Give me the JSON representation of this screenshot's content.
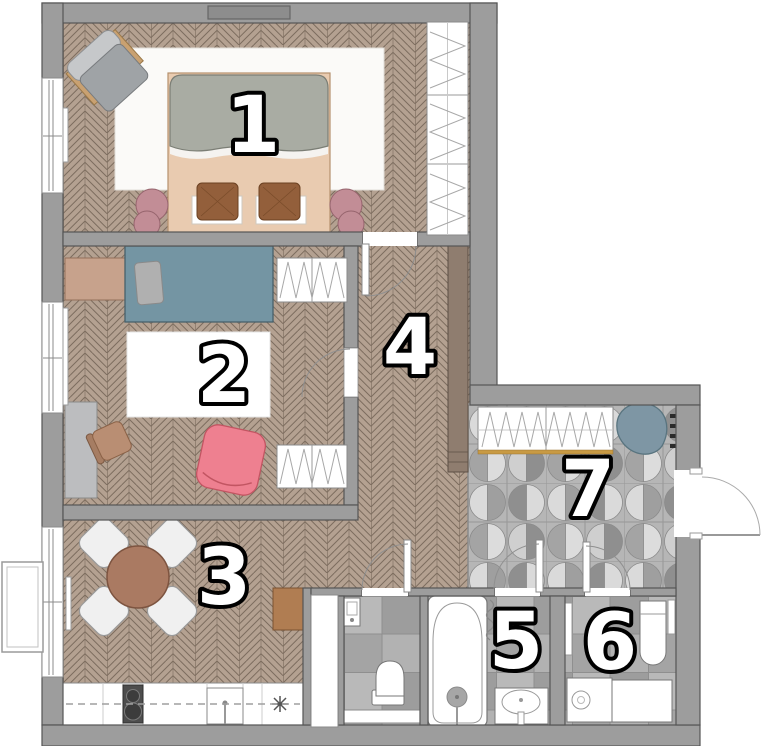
{
  "title": "Apartment floor plan",
  "rooms": [
    "1",
    "2",
    "3",
    "4",
    "5",
    "6",
    "7"
  ],
  "palette": {
    "wall": "#9d9d9d",
    "wall_outline": "#555555",
    "wood_floor": "#b4a191",
    "wood_floor_line": "#7c6c5e",
    "rug": "#fafafa",
    "tile_bg": "#b6b6b6",
    "tile_light": "#dadada",
    "tile_mid": "#a4a4a4",
    "tile_dark": "#8f8f8f",
    "bed_gray": "#a9aca3",
    "bed_peach": "#e9cbb0",
    "cushion_brown": "#935f3b",
    "pouf_mauve": "#c28d96",
    "bed_teal": "#7495a3",
    "dresser_tan": "#c7a28c",
    "armchair_pink": "#ee8090",
    "table_brown": "#aa7a62",
    "cabinet_taupe": "#8f7d6f",
    "cabinet_brown": "#b07d52",
    "wardrobe_gold": "#c89a44",
    "fixture_white": "#ffffff",
    "label_fill": "#ffffff",
    "label_outline": "#000000"
  }
}
